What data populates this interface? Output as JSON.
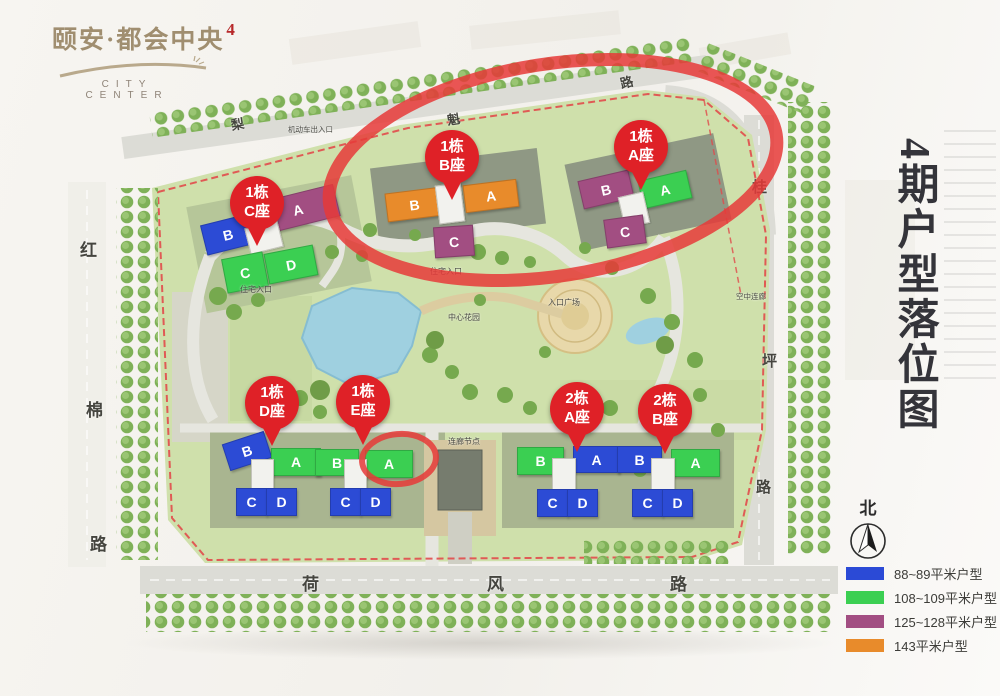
{
  "logo": {
    "brand": "颐安·都会中央",
    "seal": "4",
    "city": "CITY",
    "center": "CENTER"
  },
  "page_title_vertical": "4期户型落位图",
  "compass_label": "北",
  "legend": {
    "items": [
      {
        "color": "#2b4ad6",
        "label": "88~89平米户型"
      },
      {
        "color": "#3bcf52",
        "label": "108~109平米户型"
      },
      {
        "color": "#a24e82",
        "label": "125~128平米户型"
      },
      {
        "color": "#e88b2b",
        "label": "143平米户型"
      }
    ]
  },
  "roads": {
    "left": [
      "红",
      "棉",
      "路"
    ],
    "bottom": [
      "荷",
      "风",
      "路"
    ],
    "right": [
      "桂",
      "坪",
      "路"
    ],
    "top": [
      "梨",
      "魁",
      "路"
    ]
  },
  "map_labels": {
    "residence_entry_1": "住宅入口",
    "residence_entry_2": "住宅入口",
    "vehicle_entry": "机动车出入口",
    "central_garden": "中心花园",
    "entry_plaza": "入口广场",
    "corridor_node": "连廊节点",
    "sky_corridor": "空中连廊"
  },
  "annotation_colors": {
    "highlight_circle": "#e63a38",
    "balloon": "#df2127",
    "boundary_dash": "#e14b4b"
  },
  "clusters": [
    {
      "balloon": [
        "1栋",
        "C座"
      ],
      "blocks": [
        "B",
        "A",
        "C",
        "D"
      ]
    },
    {
      "balloon": [
        "1栋",
        "B座"
      ],
      "blocks": [
        "B",
        "A",
        "C"
      ]
    },
    {
      "balloon": [
        "1栋",
        "A座"
      ],
      "blocks": [
        "B",
        "A",
        "C"
      ]
    },
    {
      "balloon": [
        "1栋",
        "D座"
      ],
      "blocks": [
        "B",
        "A",
        "C",
        "D"
      ]
    },
    {
      "balloon": [
        "1栋",
        "E座"
      ],
      "blocks": [
        "B",
        "A",
        "C",
        "D"
      ]
    },
    {
      "balloon": [
        "2栋",
        "A座"
      ],
      "blocks": [
        "B",
        "A",
        "C",
        "D"
      ]
    },
    {
      "balloon": [
        "2栋",
        "B座"
      ],
      "blocks": [
        "B",
        "A",
        "C",
        "D"
      ]
    }
  ]
}
